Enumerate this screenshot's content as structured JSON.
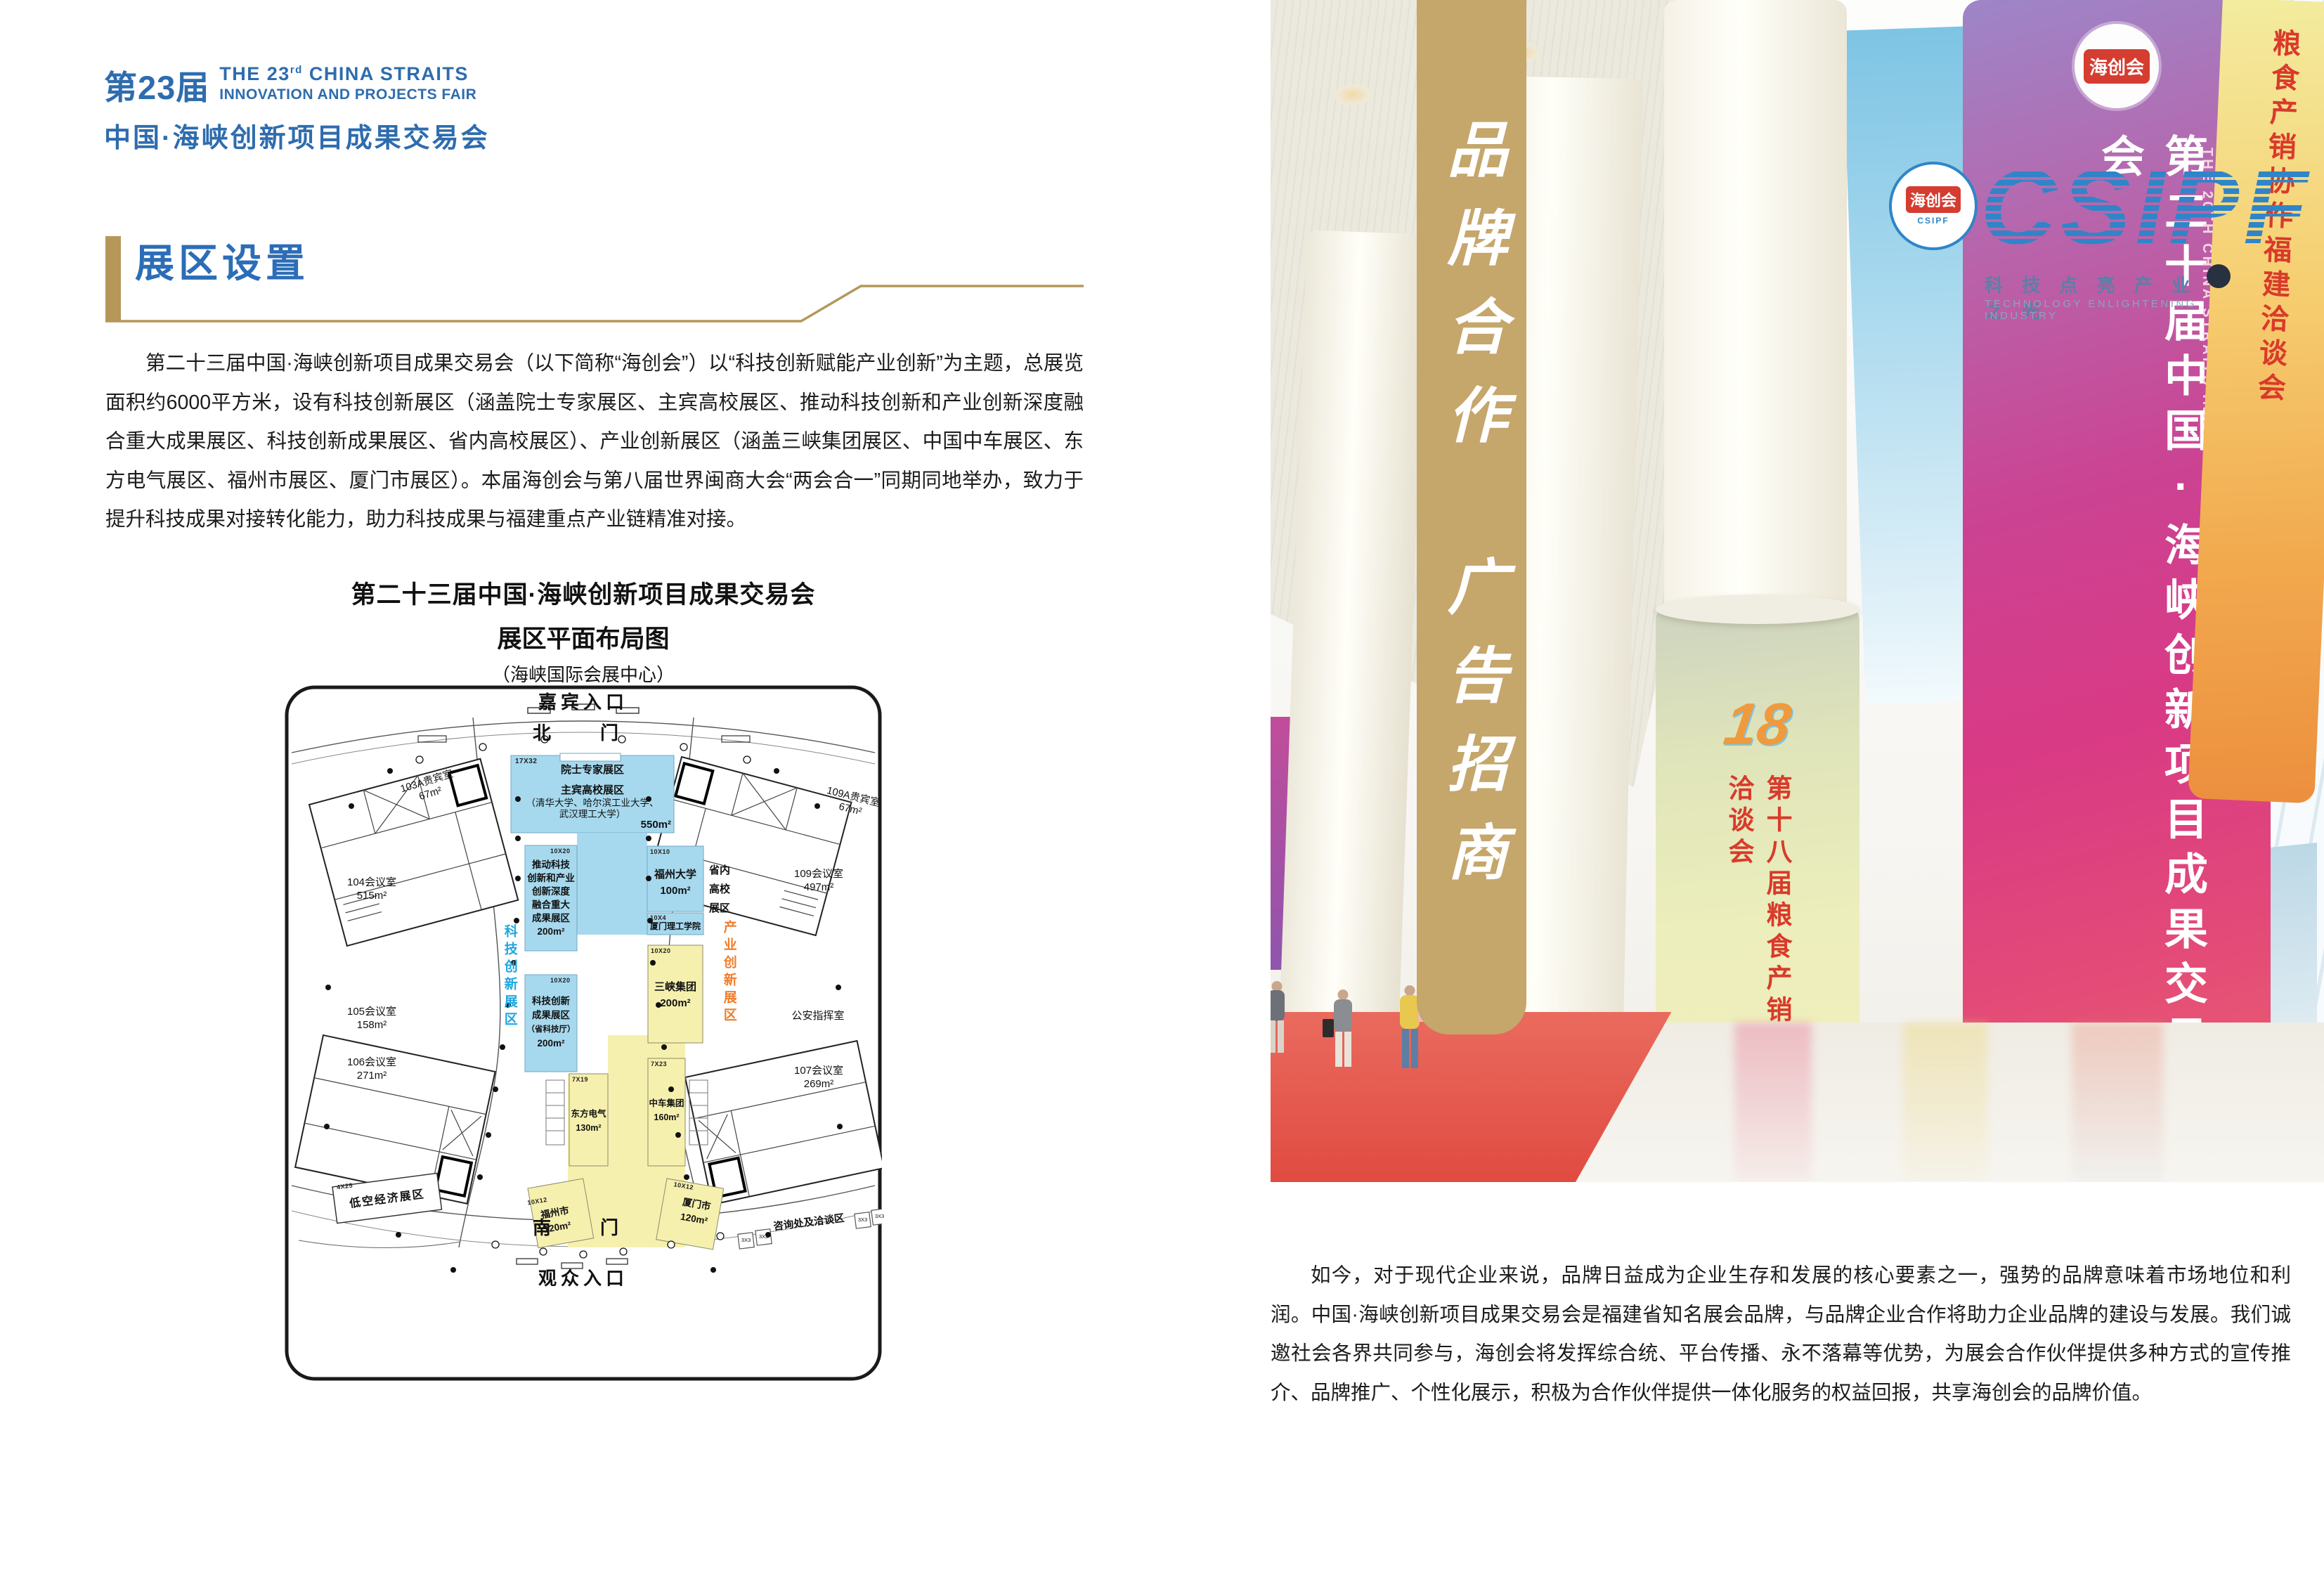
{
  "header": {
    "edition": "第23届",
    "en1a": "THE 23",
    "en1sup": "rd",
    "en1b": " CHINA STRAITS",
    "en2": "INNOVATION AND PROJECTS FAIR",
    "cn": "中国·海峡创新项目成果交易会"
  },
  "section": {
    "title": "展区设置"
  },
  "intro": "第二十三届中国·海峡创新项目成果交易会（以下简称“海创会”）以“科技创新赋能产业创新”为主题，总展览面积约6000平方米，设有科技创新展区（涵盖院士专家展区、主宾高校展区、推动科技创新和产业创新深度融合重大成果展区、科技创新成果展区、省内高校展区）、产业创新展区（涵盖三峡集团展区、中国中车展区、东方电气展区、福州市展区、厦门市展区）。本届海创会与第八届世界闽商大会“两会合一”同期同地举办，致力于提升科技成果对接转化能力，助力科技成果与福建重点产业链精准对接。",
  "plan": {
    "title1": "第二十三届中国·海峡创新项目成果交易会",
    "title2": "展区平面布局图",
    "title3": "（海峡国际会展中心）",
    "guest_entrance": "嘉宾入口",
    "north_gate": "北　门",
    "south_gate": "南　门",
    "public_entrance": "观众入口",
    "tech_zone": "科技创新展区",
    "industry_zone": "产业创新展区",
    "main_blue": {
      "tag": "17X32",
      "l1": "院士专家展区",
      "l2": "主宾高校展区",
      "l3": "（清华大学、哈尔滨工业大学、",
      "l4": "武汉理工大学）",
      "area": "550m²"
    },
    "promote": {
      "tag": "10X20",
      "l1": "推动科技",
      "l2": "创新和产业",
      "l3": "创新深度",
      "l4": "融合重大",
      "l5": "成果展区",
      "area": "200m²"
    },
    "fzu": {
      "tag": "10X10",
      "l1": "福州大学",
      "area": "100m²"
    },
    "xmut": {
      "tag": "10X4",
      "l1": "厦门理工学院"
    },
    "provincial": {
      "l1": "省内",
      "l2": "高校",
      "l3": "展区"
    },
    "tech_result": {
      "tag": "10X20",
      "l1": "科技创新",
      "l2": "成果展区",
      "l3": "（省科技厅）",
      "area": "200m²"
    },
    "sanxia": {
      "tag": "10X20",
      "l1": "三峡集团",
      "area": "200m²"
    },
    "crrc": {
      "tag": "7X23",
      "l1": "中车集团",
      "area": "160m²"
    },
    "dongfang": {
      "tag": "7X19",
      "l1": "东方电气",
      "area": "130m²"
    },
    "fuzhou": {
      "tag": "10X12",
      "l1": "福州市",
      "area": "120m²"
    },
    "xiamen": {
      "tag": "10X12",
      "l1": "厦门市",
      "area": "120m²"
    },
    "lowalt": {
      "tag": "4X25",
      "l1": "低空经济展区"
    },
    "consult": {
      "label": "咨询处及洽谈区",
      "b1": "3X3",
      "b2": "3X3",
      "b3": "3X3",
      "b4": "3X3"
    },
    "rooms": {
      "r103a": {
        "name": "103A贵宾室",
        "area": "67m²"
      },
      "r104": {
        "name": "104会议室",
        "area": "515m²"
      },
      "r105": {
        "name": "105会议室",
        "area": "158m²"
      },
      "r106": {
        "name": "106会议室",
        "area": "271m²"
      },
      "r107": {
        "name": "107会议室",
        "area": "269m²"
      },
      "r109a": {
        "name": "109A贵宾室",
        "area": "67m²"
      },
      "r109": {
        "name": "109会议室",
        "area": "497m²"
      },
      "police": {
        "name": "公安指挥室"
      }
    }
  },
  "gold_banner": {
    "g1": "品牌合作",
    "g2": "广告招商"
  },
  "photo": {
    "logo": {
      "seal_cn": "海创会",
      "seal_en": "CSIPF",
      "brand": "CSIPF",
      "tagline_cn": "科 技 点 亮 产 业 之 光",
      "tagline_en": "TECHNOLOGY ENLIGHTENING INDUSTRY"
    },
    "magenta": {
      "seal": "海创会",
      "cn": "第二十届中国·海峡创新项目成果交易会",
      "en": "THE 20TH CHINA STRAITS INNOVATION AND PROJECT FAIR"
    },
    "green": {
      "num": "18",
      "cn": "第十八届粮食产销协作福建洽谈会"
    },
    "orange": {
      "cn": "粮食产销协作福建洽谈会"
    },
    "purple": {
      "cn": "第二十届中国·海峡创新项目成"
    }
  },
  "closing": "如今，对于现代企业来说，品牌日益成为企业生存和发展的核心要素之一，强势的品牌意味着市场地位和利润。中国·海峡创新项目成果交易会是福建省知名展会品牌，与品牌企业合作将助力企业品牌的建设与发展。我们诚邀社会各界共同参与，海创会将发挥综合统、平台传播、永不落幕等优势，为展会合作伙伴提供多种方式的宣传推介、品牌推广、个性化展示，积极为合作伙伴提供一体化服务的权益回报，共享海创会的品牌价值。",
  "colors": {
    "brand_blue": "#2e6cae",
    "gold": "#c5a66b",
    "plan_blue": "#a7d9ee",
    "plan_yellow": "#f6f0ae",
    "tech_blue": "#1ea7e0",
    "industry_orange": "#f07d2a"
  }
}
